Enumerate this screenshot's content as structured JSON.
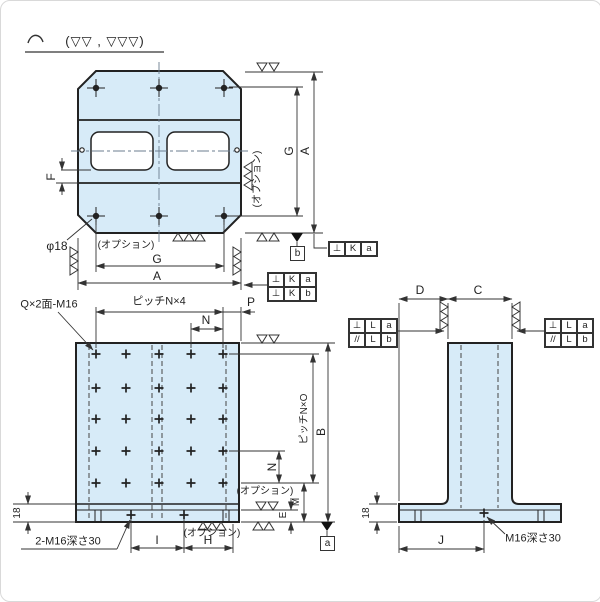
{
  "colors": {
    "plate_fill": "#d7ebf8",
    "line": "#222222",
    "dim": "#333333"
  },
  "surface_note": {
    "text": "(▽▽ , ▽▽▽)"
  },
  "top_view": {
    "dim_g_right": "G",
    "dim_a_right": "A",
    "option_right": "(オプション)",
    "dim_g_bottom": "G",
    "dim_a_bottom": "A",
    "option_bottom": "(オプション)",
    "dim_f": "F",
    "hole_label": "φ18",
    "datum_b": "b",
    "fcf_single": {
      "sym": "⊥",
      "tol": "K",
      "datum": "a"
    },
    "fcf_stack": {
      "rows": [
        {
          "sym": "⊥",
          "tol": "K",
          "datum": "a"
        },
        {
          "sym": "⊥",
          "tol": "K",
          "datum": "b"
        }
      ]
    }
  },
  "front_view": {
    "thread_label": "Q×2面-M16",
    "pitch_top": "ピッチN×4",
    "dim_n_top": "N",
    "dim_p": "P",
    "pitch_right": "ピッチN×O",
    "dim_b": "B",
    "dim_n_right": "N",
    "dim_m": "M",
    "dim_e": "E",
    "option_right": "(オプション)",
    "option_bottom": "(オプション)",
    "base_thread_label": "2-M16深さ30",
    "dim_i": "I",
    "dim_h": "H",
    "dim_thickness": "18",
    "datum_a": "a"
  },
  "side_view": {
    "dim_d": "D",
    "dim_c": "C",
    "dim_j": "J",
    "dim_thickness": "18",
    "thread_label": "M16深さ30",
    "fcf_left": {
      "rows": [
        {
          "sym": "⊥",
          "tol": "L",
          "datum": "a"
        },
        {
          "sym": "//",
          "tol": "L",
          "datum": "b"
        }
      ]
    },
    "fcf_right": {
      "rows": [
        {
          "sym": "⊥",
          "tol": "L",
          "datum": "a"
        },
        {
          "sym": "//",
          "tol": "L",
          "datum": "b"
        }
      ]
    }
  }
}
